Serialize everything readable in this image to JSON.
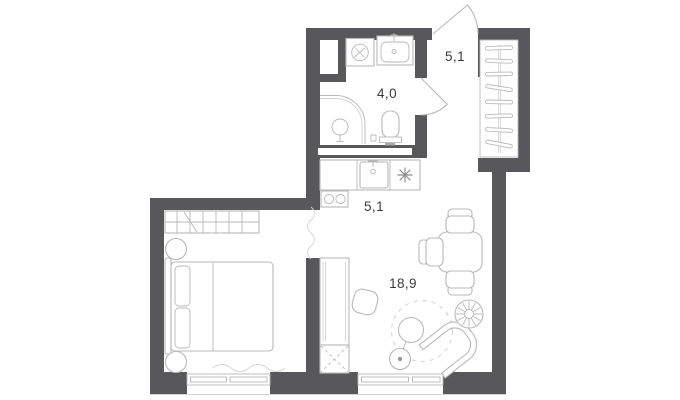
{
  "plan": {
    "rooms": [
      {
        "name": "entrance-hall",
        "area_label": "5,1"
      },
      {
        "name": "bathroom",
        "area_label": "4,0"
      },
      {
        "name": "kitchen",
        "area_label": "5,1"
      },
      {
        "name": "living-room",
        "area_label": "18,9"
      }
    ],
    "furniture": [
      "entrance-door",
      "hall-wardrobe-hangers",
      "washing-machine",
      "bathroom-sink",
      "shower",
      "toilet",
      "bathroom-door",
      "kitchen-counter",
      "kitchen-sink",
      "hob-symbol",
      "cooktop",
      "dining-table",
      "dining-chairs",
      "pouf",
      "tall-cabinet",
      "ventilation-box",
      "rug",
      "floor-lamp",
      "armchair",
      "plant",
      "double-bed",
      "pillows",
      "nightstands",
      "bedroom-wardrobe",
      "curtains",
      "windows"
    ],
    "colors": {
      "wall": "#58585a",
      "furniture_line": "#b9b9b9",
      "label_text": "#3b3b3b",
      "background": "#ffffff"
    }
  }
}
